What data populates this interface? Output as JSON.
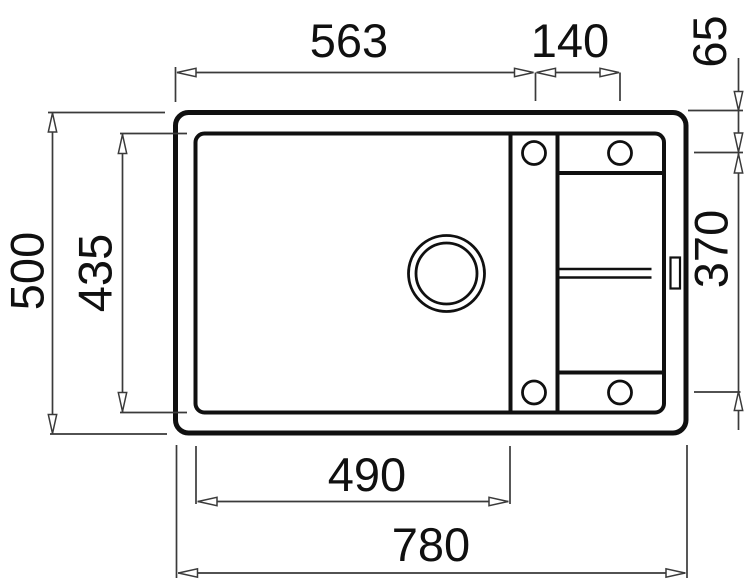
{
  "drawing": {
    "type": "technical-dimension-drawing",
    "colors": {
      "outline": "#101010",
      "dimension_lines": "#3a3a3a",
      "background": "#ffffff"
    },
    "dimensions": {
      "left_edge_to_tap_center": "563",
      "tap_hole_spacing": "140",
      "tap_center_to_top_edge": "65",
      "overall_depth": "500",
      "bowl_inner_depth": "435",
      "tap_row_vertical_spacing": "370",
      "bowl_inner_width": "490",
      "overall_width": "780"
    }
  }
}
